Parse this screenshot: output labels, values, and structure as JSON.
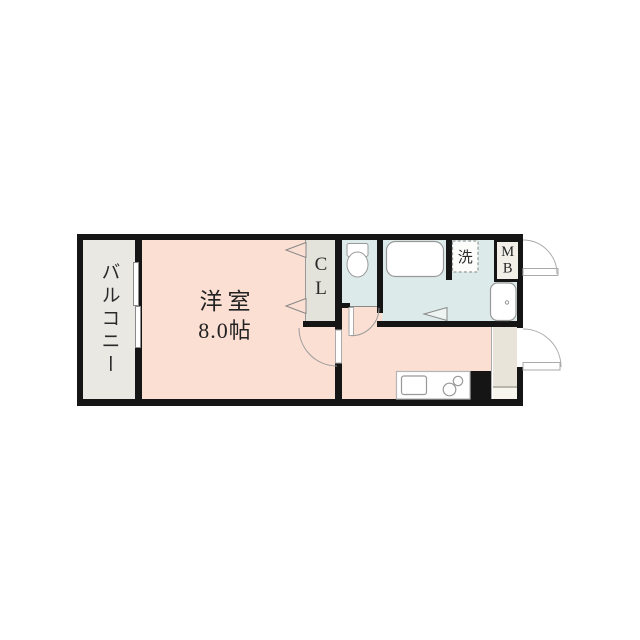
{
  "floorplan": {
    "balcony": {
      "label": "バルコニー"
    },
    "western_room": {
      "name": "洋室",
      "size": "8.0帖"
    },
    "closet": {
      "label": "CL"
    },
    "laundry": {
      "label": "洗"
    },
    "meter_box": {
      "label": "MB"
    },
    "colors": {
      "room": "#fbdfd3",
      "wet_area": "#dcebea",
      "balcony": "#e9e8e2",
      "closet": "#e3e2db",
      "entry": "#e8e4d9",
      "entry_step": "#f7f5ee",
      "wall": "#151515",
      "fixture_stroke": "#999999",
      "text": "#232323"
    }
  }
}
